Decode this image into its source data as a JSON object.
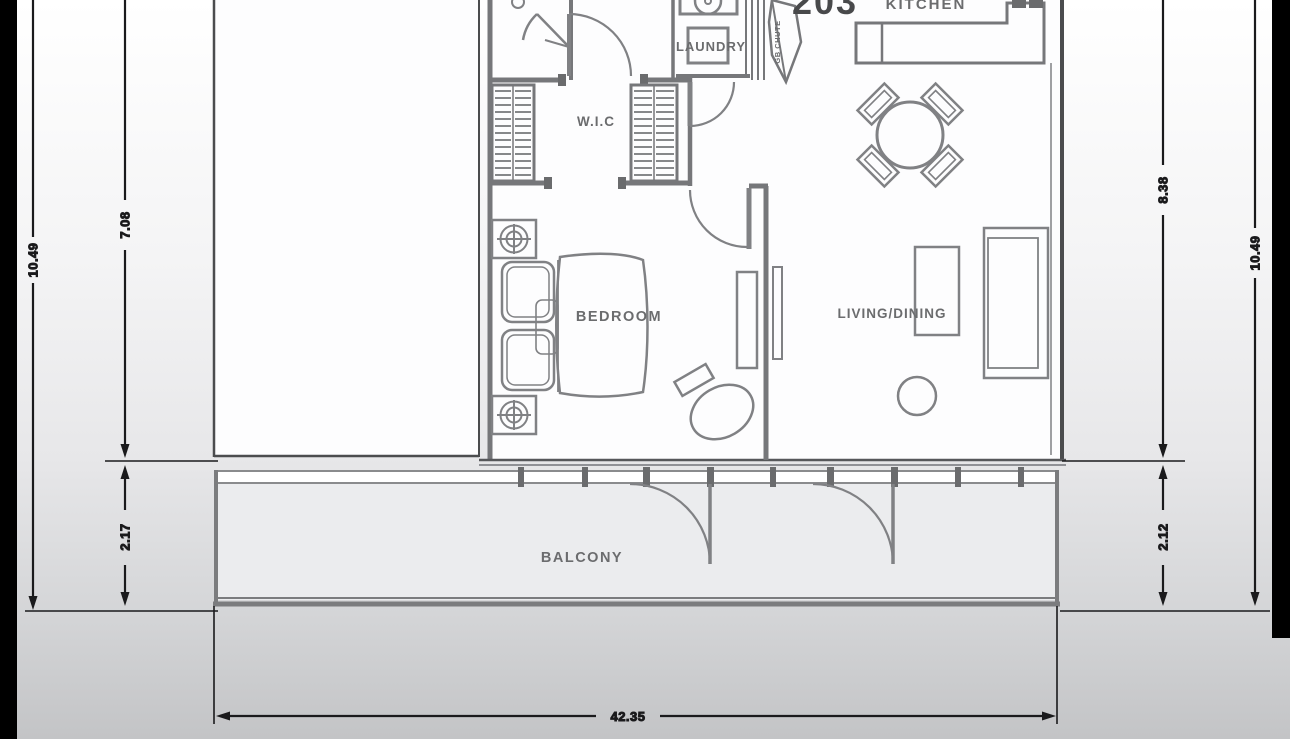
{
  "plan": {
    "unit_number": "203",
    "labels": {
      "kitchen": "KITCHEN",
      "laundry": "LAUNDRY",
      "wic": "W.I.C",
      "bedroom": "BEDROOM",
      "living_dining": "LIVING/DINING",
      "balcony": "BALCONY",
      "chute": "GB CHUTE"
    },
    "dimensions": {
      "left_outer": "10.49",
      "left_inner_top": "7.08",
      "left_inner_bottom": "2.17",
      "right_inner_top": "8.38",
      "right_inner_bottom": "2.12",
      "right_outer": "10.49",
      "bottom_width": "42.35"
    },
    "symbols": [
      "bed-symbol",
      "pillow-symbol",
      "nightstand-lamp-symbol",
      "desk-chair-symbol",
      "closet-hanger-symbol",
      "washer-symbol",
      "dryer-symbol",
      "garbage-chute-symbol",
      "kitchen-counter-symbol",
      "dining-table-symbol",
      "dining-chair-symbol",
      "sofa-symbol",
      "coffee-table-symbol",
      "pouf-symbol",
      "door-swing-symbol",
      "window-band-symbol"
    ],
    "colors": {
      "wall_gray": "#76777a",
      "furniture_gray": "#818285",
      "label_gray": "#6b6c6e",
      "dimension_black": "#1a1a1c",
      "background_top": "#ffffff",
      "background_bottom": "#c3c4c6",
      "photo_border_black": "#000000"
    }
  }
}
